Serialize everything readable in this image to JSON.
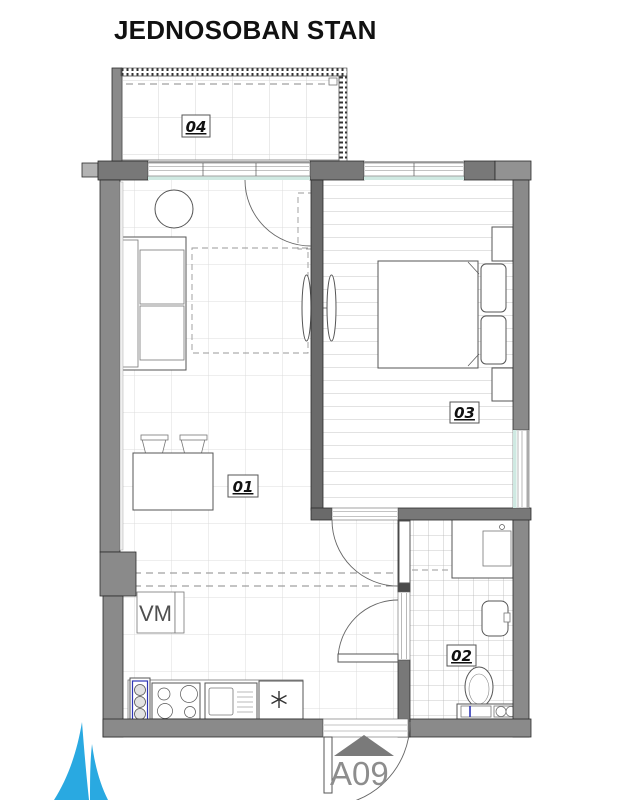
{
  "title": "JEDNOSOBAN STAN",
  "unit_label": "A09",
  "rooms": {
    "living": {
      "number": "01"
    },
    "bathroom": {
      "number": "02"
    },
    "bedroom": {
      "number": "03"
    },
    "balcony": {
      "number": "04"
    }
  },
  "annotations": {
    "washing_machine": "VM"
  },
  "colors": {
    "wall_gray": "#8a8a8a",
    "wall_dark": "#6a6a6a",
    "wall_light": "#b3b3b3",
    "window_accent": "#cfe9e2",
    "fixture_blue": "#2d35b5",
    "logo_blue": "#29a9e1",
    "unit_text_gray": "#8d8d8d",
    "grid_line": "#dcdcdc"
  }
}
